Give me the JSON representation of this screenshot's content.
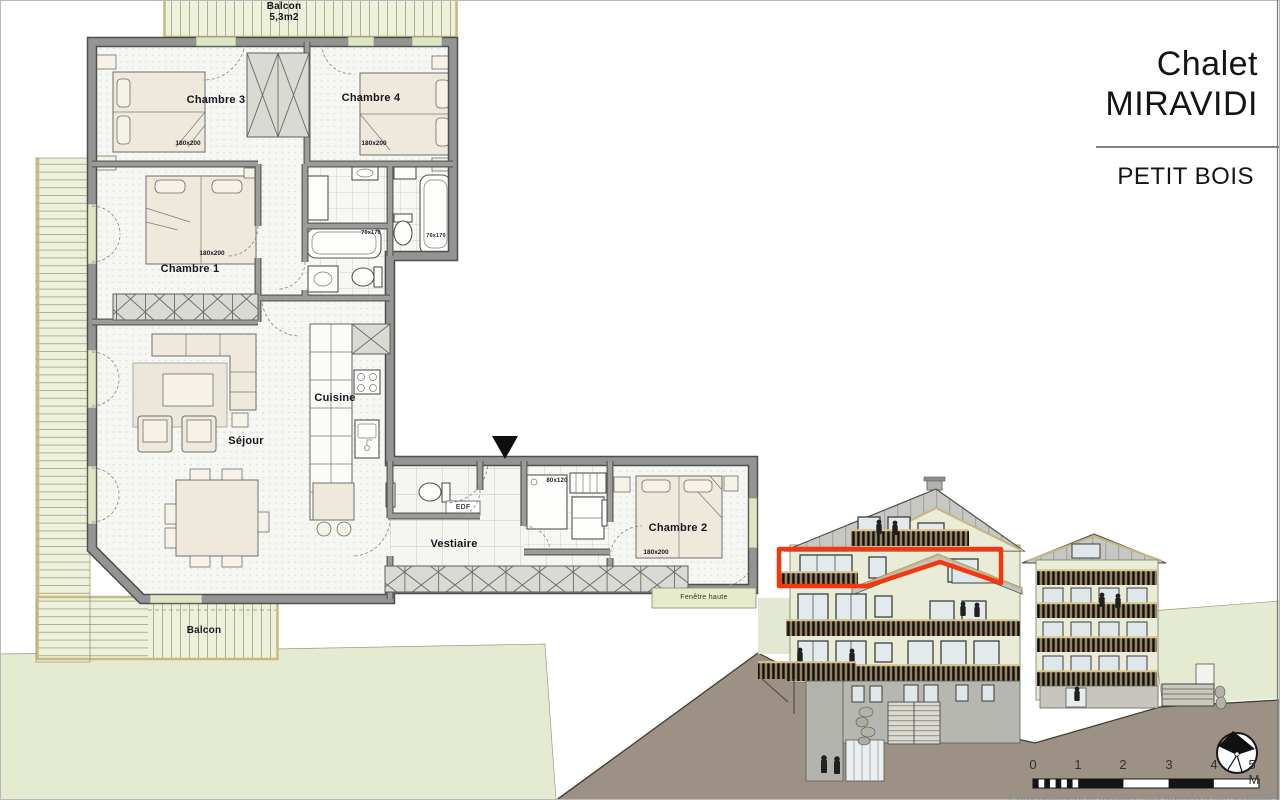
{
  "title_block": {
    "name_line1": "Chalet",
    "name_line2": "MIRAVIDI",
    "project": "PETIT BOIS"
  },
  "plan": {
    "labels": {
      "balcon_top": "Balcon",
      "balcon_top_area": "5,3m2",
      "chambre3": "Chambre 3",
      "chambre3_dim": "180x200",
      "chambre4": "Chambre 4",
      "chambre4_dim": "180x200",
      "chambre1": "Chambre 1",
      "chambre1_dim": "180x200",
      "sejour": "Séjour",
      "cuisine": "Cuisine",
      "vestiaire": "Vestiaire",
      "edf": "EDF",
      "shower_dim": "80x120",
      "bath_dim_a": "70x170",
      "bath_dim_b": "70x170",
      "chambre2": "Chambre 2",
      "chambre2_dim": "180x200",
      "fenetre_haute": "Fenêtre haute",
      "balcon_bottom": "Balcon"
    }
  },
  "elevation": {
    "highlight_color": "#f4370e"
  },
  "scale_bar": {
    "ticks": [
      "0",
      "1",
      "2",
      "3",
      "4",
      "5 M"
    ]
  },
  "footer": {
    "disclaimer": "L'ameublement et mobilier sont donnés à titre indicatif"
  },
  "colors": {
    "deck": "#edf0da",
    "wall": "#919191",
    "facade": "#e9edd8",
    "roof": "#c7c7c4",
    "grass": "#e5ebd1",
    "ground": "#9c9184",
    "highlight": "#f4370e"
  }
}
